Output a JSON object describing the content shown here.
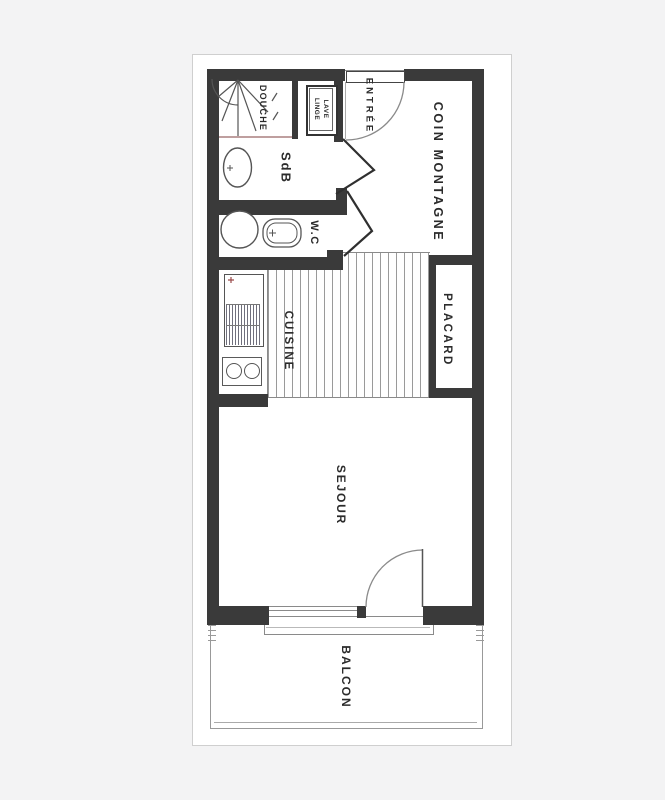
{
  "document": {
    "type": "apartment-floor-plan",
    "sheet_background": "#ffffff",
    "canvas_background": "#f3f3f4",
    "wall_color": "#3a3a3a",
    "line_color": "#8a8a8a",
    "accent_line_color": "#bf9f9f"
  },
  "rooms": {
    "douche": {
      "label": "DOUCHE"
    },
    "lave_linge": {
      "label_line1": "LAVE",
      "label_line2": "LINGE"
    },
    "entree": {
      "label": "ENTRÉE"
    },
    "coin_montagne": {
      "label": "COIN MONTAGNE"
    },
    "sdb": {
      "label": "SdB"
    },
    "wc": {
      "label": "W.C"
    },
    "cuisine": {
      "label": "CUISINE"
    },
    "placard": {
      "label": "PLACARD"
    },
    "sejour": {
      "label": "SEJOUR"
    },
    "balcon": {
      "label": "BALCON"
    }
  }
}
